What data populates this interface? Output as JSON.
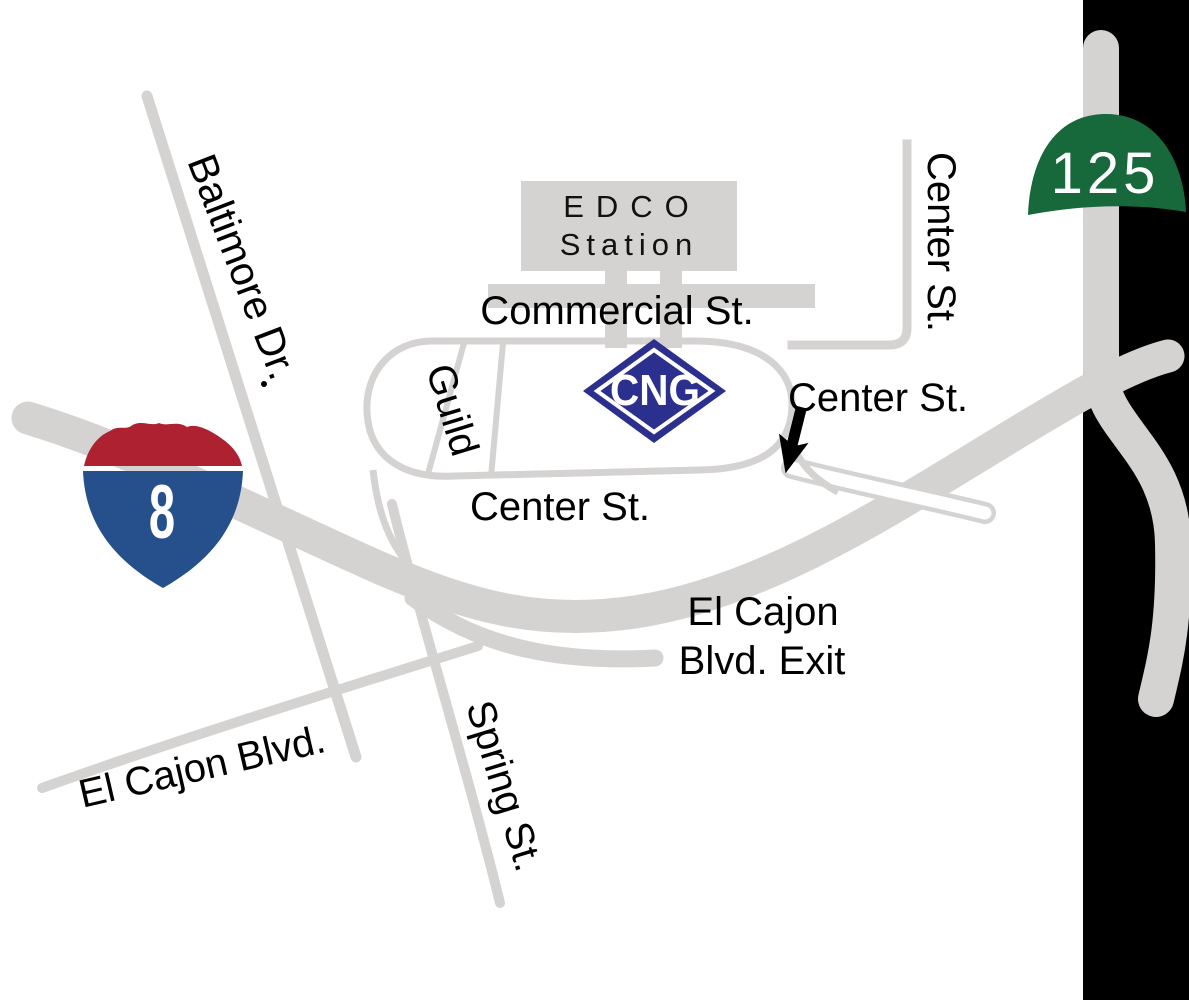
{
  "map": {
    "edco_box": {
      "line1": "EDCO",
      "line2": "Station"
    },
    "streets": {
      "commercial": "Commercial St.",
      "center_upper": "Center St.",
      "center_arrow": "Center St.",
      "center_inner": "Center St.",
      "guild": "Guild",
      "baltimore": "Baltimore Dr.",
      "spring": "Spring St.",
      "el_cajon": "El Cajon Blvd.",
      "exit_line1": "El Cajon",
      "exit_line2": "Blvd. Exit"
    },
    "shields": {
      "interstate_8": "8",
      "route_125": "125"
    },
    "cng_marker": "CNG",
    "colors": {
      "road": "#d5d2d2",
      "panel": "#000000",
      "i8_red": "#ae2130",
      "i8_blue": "#25508c",
      "route_green": "#17693b",
      "cng_blue": "#2b2f8e",
      "black": "#000000",
      "white": "#ffffff"
    }
  }
}
